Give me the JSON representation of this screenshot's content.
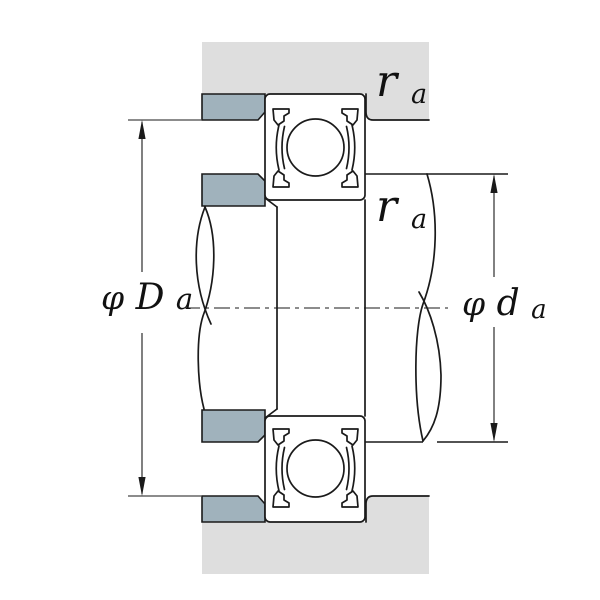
{
  "diagram": {
    "type": "bearing-mounting-cross-section",
    "labels": {
      "housing_abutment_diameter": {
        "prefix": "φ",
        "main": "D",
        "sub": "a"
      },
      "shaft_abutment_diameter": {
        "prefix": "φ",
        "main": "d",
        "sub": "a"
      },
      "fillet_radius_housing": {
        "main": "r",
        "sub": "a"
      },
      "fillet_radius_shaft": {
        "main": "r",
        "sub": "a"
      }
    },
    "colors": {
      "housing_fill": "#dedede",
      "shoulder_block_fill": "#a0b2bc",
      "line": "#1a1a1a",
      "background": "#ffffff"
    }
  }
}
